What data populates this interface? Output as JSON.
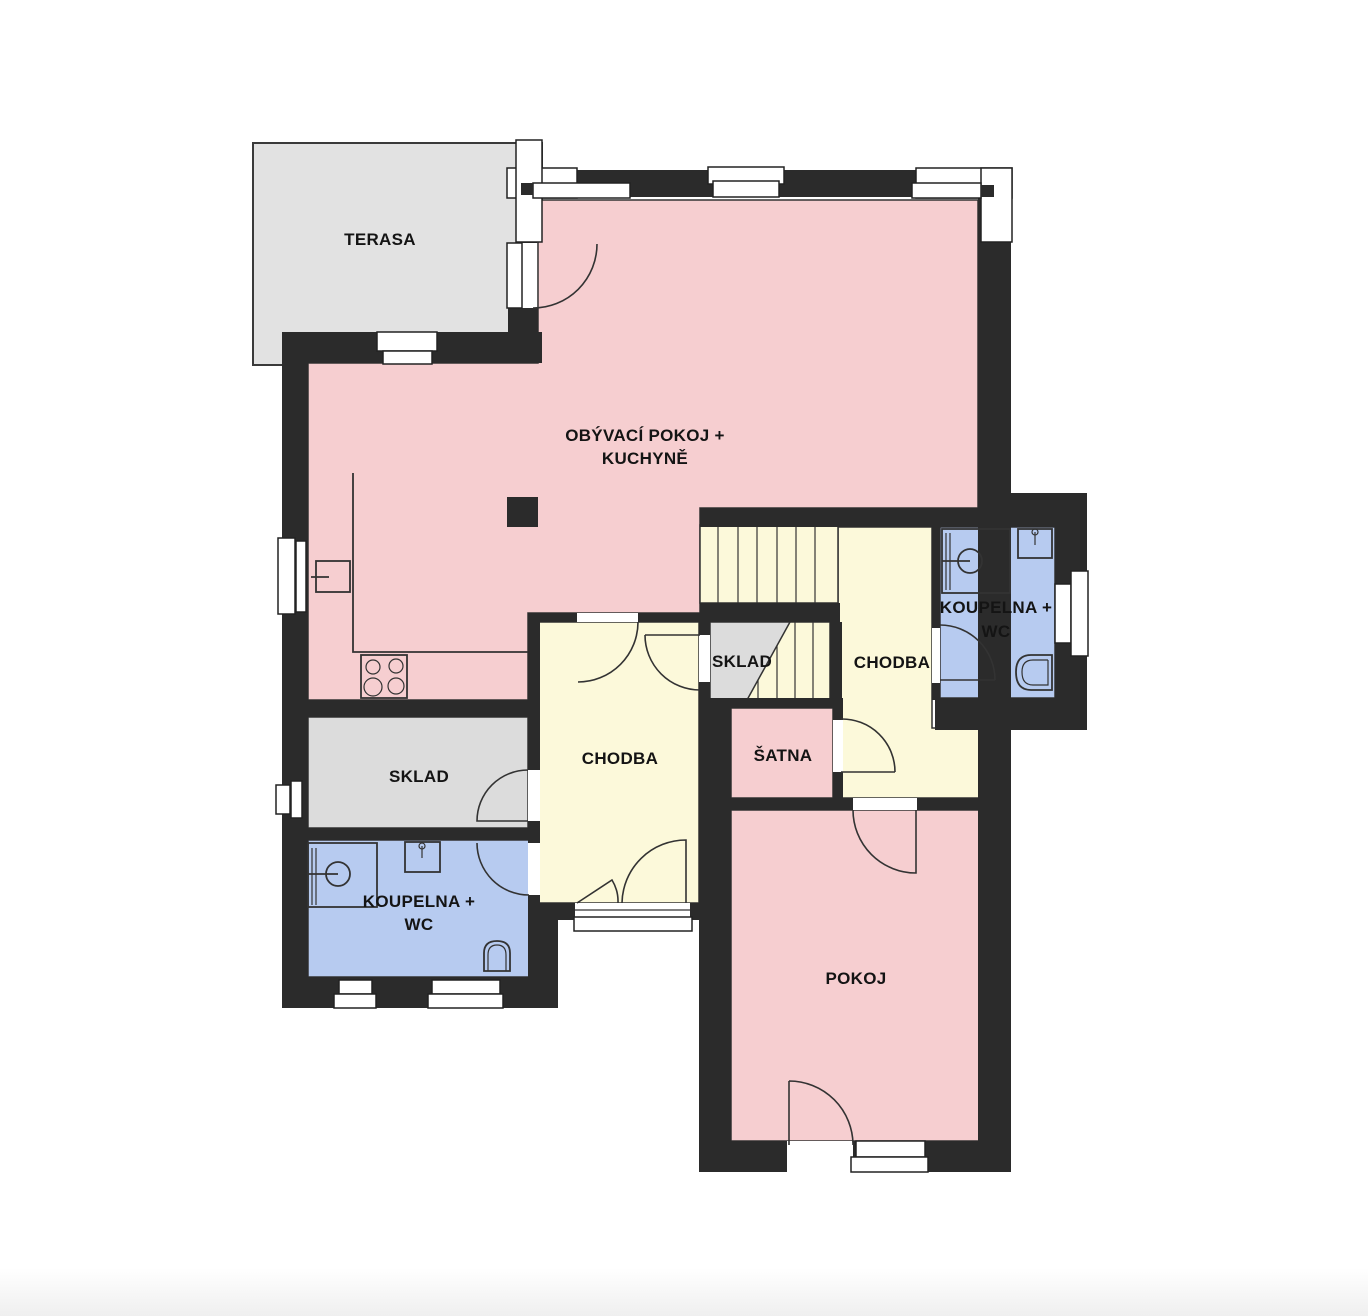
{
  "plan": {
    "type": "floor-plan",
    "rooms": {
      "terasa": {
        "label": "TERASA"
      },
      "living": {
        "label_line1": "OBÝVACÍ POKOJ +",
        "label_line2": "KUCHYNĚ"
      },
      "sklad_stair": {
        "label": "SKLAD"
      },
      "chodba_upper": {
        "label": "CHODBA"
      },
      "koupelna_upper": {
        "label_line1": "KOUPELNA +",
        "label_line2": "WC"
      },
      "satna": {
        "label": "ŠATNA"
      },
      "sklad_left": {
        "label": "SKLAD"
      },
      "chodba_main": {
        "label": "CHODBA"
      },
      "koupelna_lower": {
        "label_line1": "KOUPELNA +",
        "label_line2": "WC"
      },
      "pokoj": {
        "label": "POKOJ"
      }
    }
  },
  "colors": {
    "background": "#ffffff",
    "wall": "#2b2b2b",
    "living_pink": "#f6ced0",
    "hallway_yellow": "#fcf9da",
    "bathroom_blue": "#b7cbf0",
    "storage_gray": "#dcdcdc",
    "terrace_gray": "#e2e2e2",
    "label_text": "#141414",
    "footer_gray": "#f0f0f0"
  }
}
